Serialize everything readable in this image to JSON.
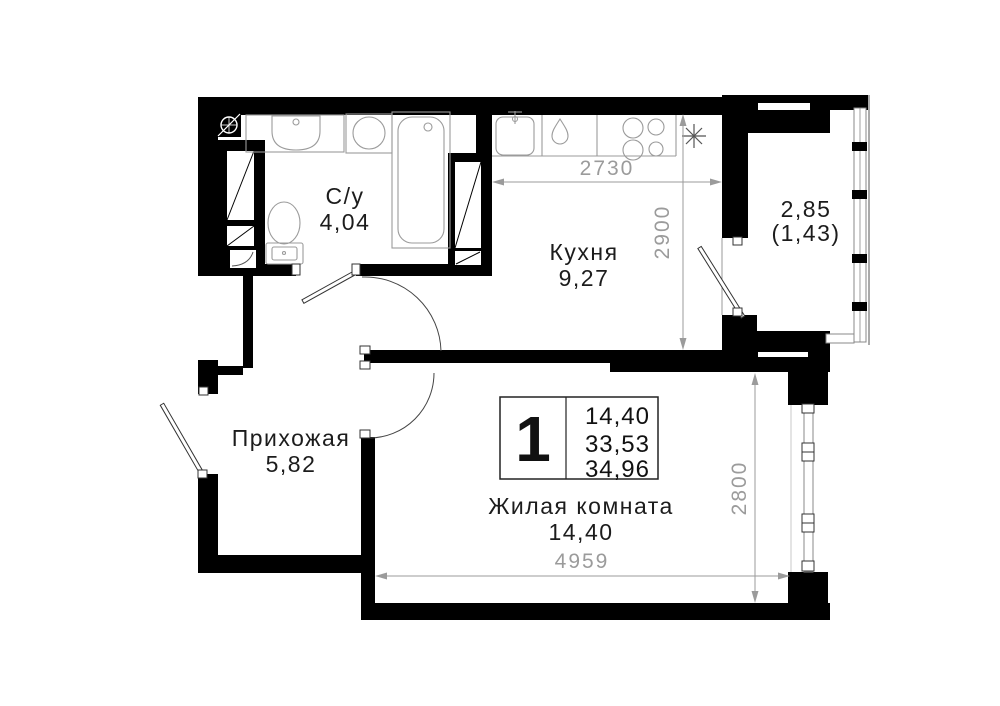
{
  "rooms": {
    "bathroom": {
      "label": "С/у",
      "area": "4,04"
    },
    "kitchen": {
      "label": "Кухня",
      "area": "9,27"
    },
    "hallway": {
      "label": "Прихожая",
      "area": "5,82"
    },
    "living": {
      "label": "Жилая комната",
      "area": "14,40"
    },
    "balcony": {
      "area": "2,85",
      "area_coeff": "(1,43)"
    }
  },
  "dimensions": {
    "kitchen_width_mm": "2730",
    "kitchen_depth_mm": "2900",
    "living_width_mm": "4959",
    "living_depth_mm": "2800"
  },
  "info_box": {
    "room_count": "1",
    "living_area_m2": "14,40",
    "area_m2": "33,53",
    "total_area_m2": "34,96"
  },
  "icons": {
    "ventilation": "vent-shaft-symbol",
    "freezer_star": "asterisk-symbol"
  },
  "colors": {
    "wall": "#000000",
    "fixture_line": "#9b9b9b",
    "dimension": "#9b9b9b",
    "label_text": "#1c1c1c"
  }
}
